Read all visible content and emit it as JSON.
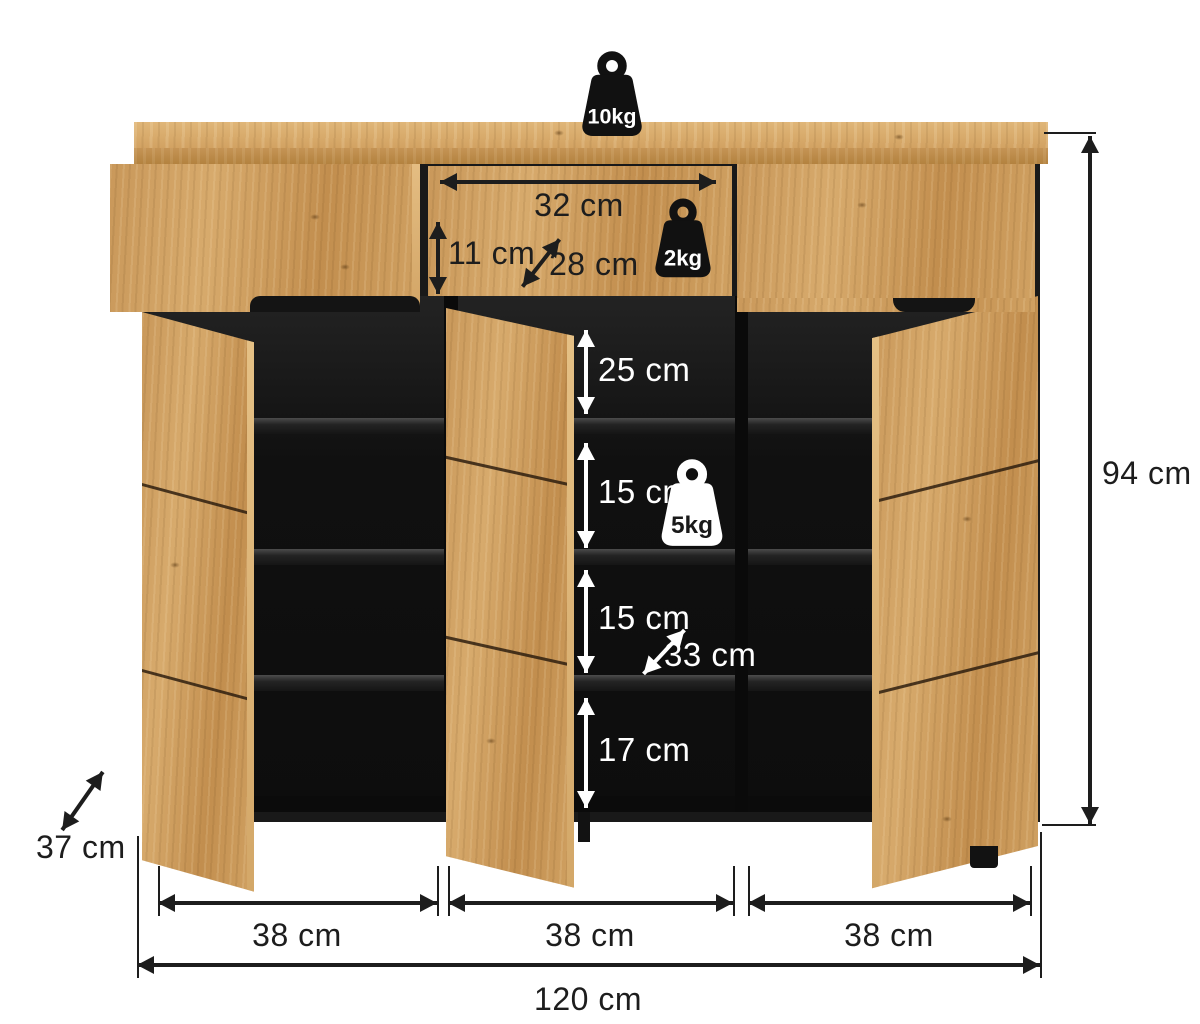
{
  "image": {
    "kind": "furniture dimension diagram",
    "subject": "three-door shoe cabinet with drawers"
  },
  "colors": {
    "wood": "#cf9f60",
    "interior": "#141414",
    "ink": "#1d1d1d",
    "light": "#ffffff"
  },
  "weights": {
    "top": "10kg",
    "drawer": "2kg",
    "shelf": "5kg"
  },
  "dims": {
    "drawer_width": "32 cm",
    "drawer_height": "11 cm",
    "drawer_depth": "28 cm",
    "comp1": "25 cm",
    "comp2": "15 cm",
    "comp3": "15 cm",
    "comp4": "17 cm",
    "shelf_depth": "33 cm",
    "height": "94 cm",
    "depth": "37 cm",
    "width": "120 cm",
    "sec1": "38 cm",
    "sec2": "38 cm",
    "sec3": "38 cm"
  }
}
